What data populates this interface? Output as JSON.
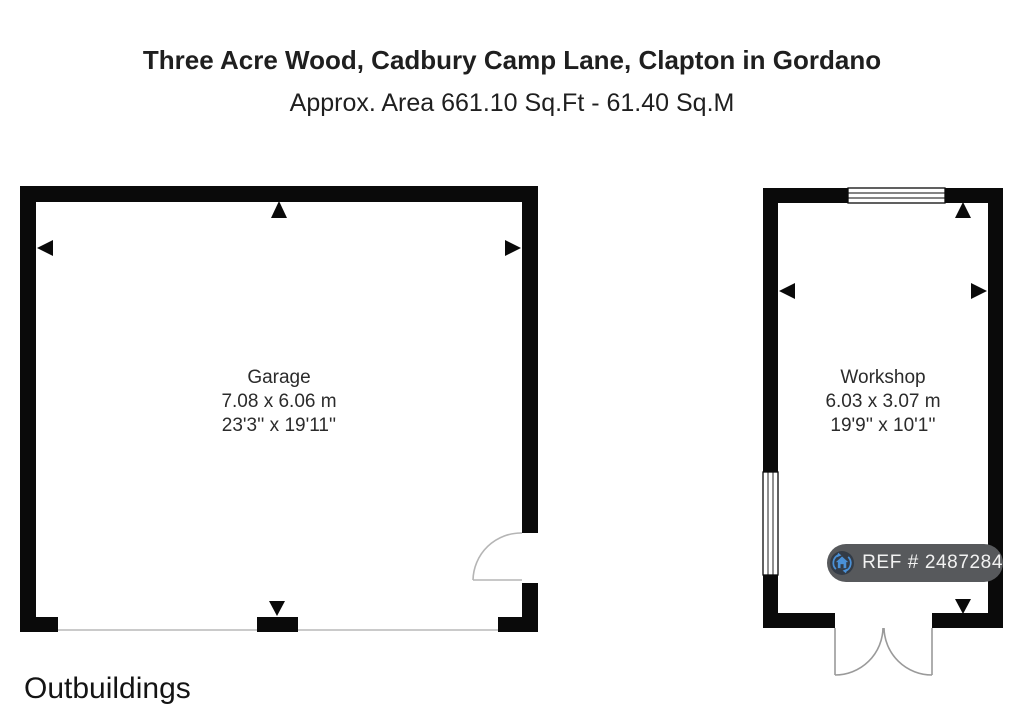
{
  "header": {
    "title": "Three Acre Wood, Cadbury Camp Lane, Clapton in Gordano",
    "subtitle": "Approx. Area 661.10 Sq.Ft - 61.40 Sq.M"
  },
  "rooms": [
    {
      "name": "Garage",
      "size_metric": "7.08 x 6.06 m",
      "size_imperial": "23'3'' x 19'11''"
    },
    {
      "name": "Workshop",
      "size_metric": "6.03 x 3.07 m",
      "size_imperial": "19'9'' x 10'1''"
    }
  ],
  "ref_badge": {
    "label": "REF # 2487284",
    "icon": "house-circular-arrows-icon"
  },
  "footer": {
    "label": "Outbuildings"
  },
  "icons": {
    "ref_badge_icon": "house-circular-arrows",
    "dimension_markers": "black-triangle-arrows"
  },
  "colors": {
    "wall": "#0a0a0a",
    "text": "#1f1f1f",
    "door_line": "#9a9a9a",
    "threshold_line": "#c2c2c2",
    "badge_bg": "#57595c",
    "badge_text": "#f2f2f2",
    "icon_circle": "#333b46",
    "icon_blue": "#4a90d6"
  }
}
